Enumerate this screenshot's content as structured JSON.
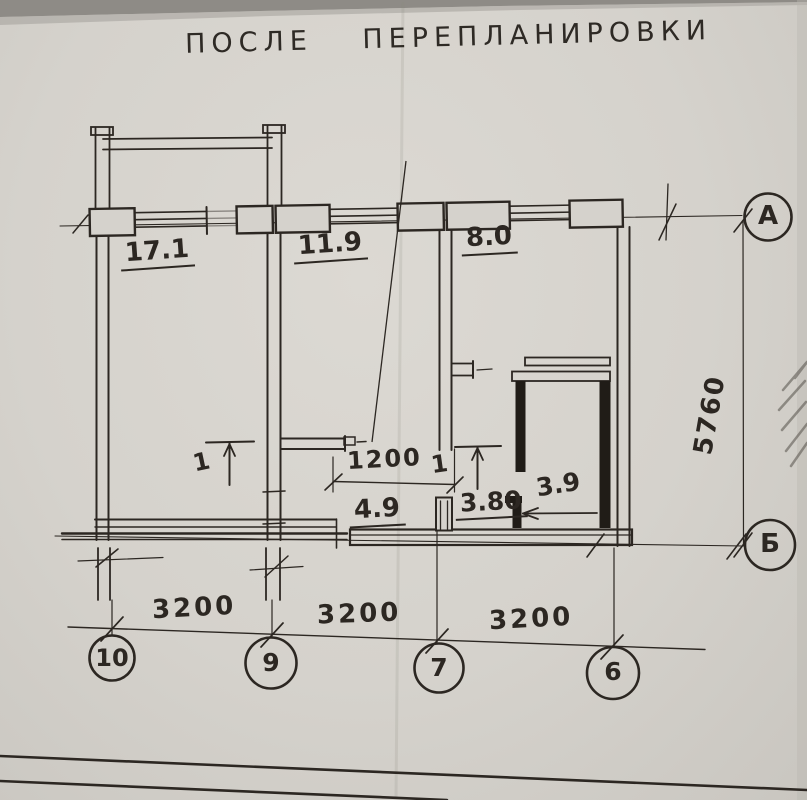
{
  "title": "ПОСЛЕ ПЕРЕПЛАНИРОВКИ",
  "colors": {
    "paper": "#d5d2cc",
    "ink": "#2c2722",
    "pencil": "#55514a"
  },
  "rooms": [
    {
      "name": "living-room",
      "area": "17.1"
    },
    {
      "name": "bedroom",
      "area": "11.9"
    },
    {
      "name": "kitchen",
      "area": "8.0"
    },
    {
      "name": "corridor",
      "area": "4.9"
    },
    {
      "name": "hallway",
      "area": "3.80"
    },
    {
      "name": "bathroom",
      "area": "3.9"
    }
  ],
  "dimensions": {
    "door_opening": "1200",
    "bays": [
      "3200",
      "3200",
      "3200"
    ],
    "depth": "5760"
  },
  "axes": {
    "horizontal": [
      "А",
      "Б"
    ],
    "vertical": [
      "10",
      "9",
      "7",
      "6"
    ]
  },
  "door_marks": [
    "1",
    "1"
  ]
}
